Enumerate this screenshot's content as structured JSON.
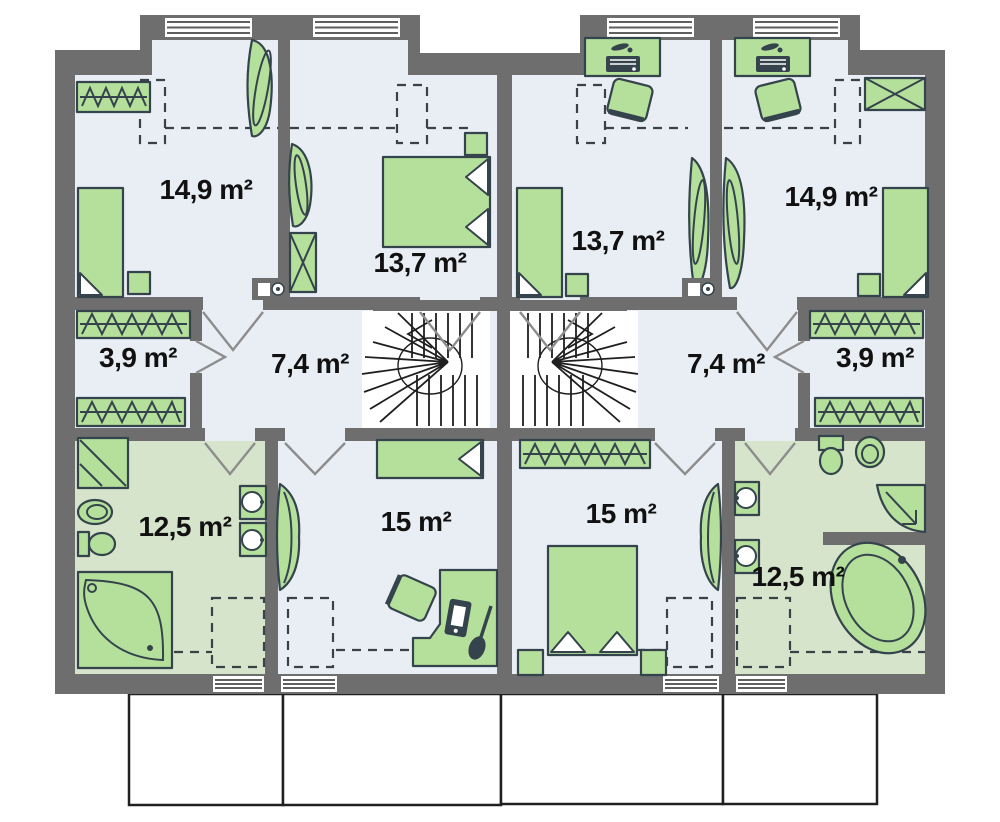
{
  "colors": {
    "background": "#ffffff",
    "wall": "#6e6e6e",
    "floor": "#e9edf4",
    "bath-floor": "#d6e4cb",
    "furniture": "#b5e09c",
    "furniture-stroke": "#35444c",
    "window-line": "#5f5f5f",
    "door-line": "#8d8d8d",
    "dash-line": "#3a4248",
    "footprint-outline": "#202020",
    "label": "#111111"
  },
  "rooms": [
    {
      "unit": "left",
      "name": "bedroom-1",
      "area": "14,9 m²"
    },
    {
      "unit": "left",
      "name": "bedroom-2",
      "area": "13,7 m²"
    },
    {
      "unit": "left",
      "name": "wardrobe",
      "area": "3,9 m²"
    },
    {
      "unit": "left",
      "name": "hall",
      "area": "7,4 m²"
    },
    {
      "unit": "left",
      "name": "bathroom",
      "area": "12,5 m²"
    },
    {
      "unit": "left",
      "name": "bedroom-3",
      "area": "15 m²"
    },
    {
      "unit": "right",
      "name": "bedroom-2",
      "area": "13,7 m²"
    },
    {
      "unit": "right",
      "name": "bedroom-1",
      "area": "14,9 m²"
    },
    {
      "unit": "right",
      "name": "hall",
      "area": "7,4 m²"
    },
    {
      "unit": "right",
      "name": "wardrobe",
      "area": "3,9 m²"
    },
    {
      "unit": "right",
      "name": "bedroom-3",
      "area": "15 m²"
    },
    {
      "unit": "right",
      "name": "bathroom",
      "area": "12,5 m²"
    }
  ],
  "icons": [
    "bed",
    "nightstand",
    "wardrobe-rack",
    "sliding-wardrobe",
    "shelving",
    "desk",
    "desk-lamp",
    "laptop",
    "office-chair",
    "guitar",
    "winder-stairs",
    "shower",
    "washbasin",
    "toilet",
    "corner-bathtub",
    "oval-bathtub",
    "door-swing",
    "window",
    "headroom-dashed-line"
  ]
}
